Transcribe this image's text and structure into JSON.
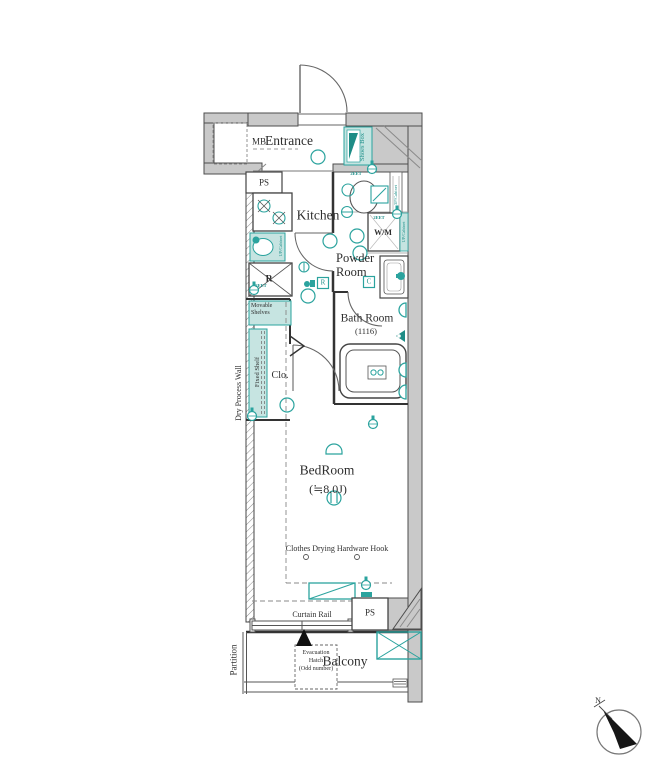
{
  "plan": {
    "rooms": {
      "entrance": "Entrance",
      "kitchen": "Kitchen",
      "powder_line1": "Powder",
      "powder_line2": "Room",
      "bath": "Bath Room",
      "bath_size": "(1116)",
      "bedroom": "BedRoom",
      "bedroom_size": "(≒8.0J)",
      "balcony": "Balcony",
      "closet": "Clo."
    },
    "fixtures": {
      "mb": "MB",
      "ps_top": "PS",
      "ps_bottom": "PS",
      "shoes_box": "Shoes Box",
      "wm": "W/M",
      "fridge": "R",
      "badge_r": "R",
      "badge_c": "C",
      "movable_shelves": "Movable Shelves",
      "fixed_shelf": "Fixed Shelf",
      "cabinet_3p": "3P/Cabinet",
      "cabinet_up": "UP/Cabinet",
      "outlet": "2EET"
    },
    "annotations": {
      "dry_process_wall": "Dry Process Wall",
      "partition": "Partition",
      "curtain_rail": "Curtain Rail",
      "clothes_hook": "Clothes Drying Hardware Hook",
      "evac_line1": "Evacuation",
      "evac_line2": "Hatch",
      "evac_line3": "(Odd number)",
      "north": "N"
    },
    "colors": {
      "accent": "#2ba39e",
      "accent_fill": "#c6e4e1",
      "wall": "#c9c9c9"
    }
  }
}
